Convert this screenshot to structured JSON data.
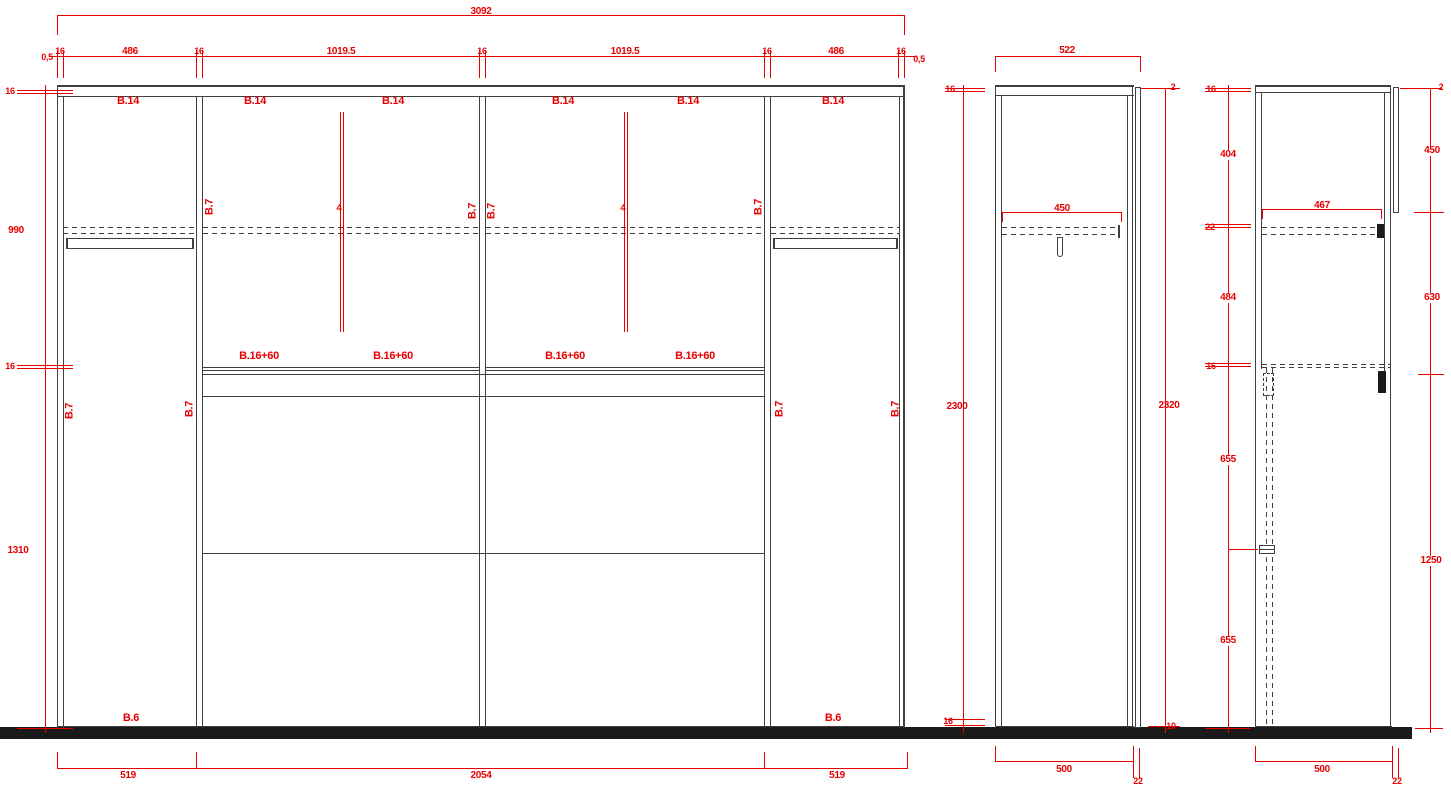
{
  "drawing": {
    "type": "cad-elevation-wardrobe",
    "colors": {
      "dimension_red": "#e80000",
      "cabinet_line": "#3f3f3f",
      "floor_black": "#1a1a1a",
      "background": "#ffffff"
    },
    "front_view": {
      "dim_overall_width": "3092",
      "dims_width_row": [
        "0,5",
        "16",
        "486",
        "16",
        "1019.5",
        "16",
        "1019.5",
        "16",
        "486",
        "16",
        "0,5"
      ],
      "dims_left_chain": [
        "16",
        "990",
        "16",
        "1310"
      ],
      "dims_bottom": [
        "519",
        "2054",
        "519"
      ],
      "top_panel_labels": [
        "B.14",
        "B.14",
        "B.14",
        "B.14",
        "B.14",
        "B.14"
      ],
      "shelf_labels": [
        "B.16+60",
        "B.16+60",
        "B.16+60",
        "B.16+60"
      ],
      "bottom_labels": [
        "B.6",
        "B.6"
      ],
      "side_panel_labels": [
        "B.7",
        "B.7",
        "B.7",
        "B.7",
        "B.7",
        "B.7",
        "B.7",
        "B.7"
      ],
      "center_line_labels": [
        "4",
        "4"
      ]
    },
    "side_view_middle": {
      "dim_top_width": "522",
      "dim_shelf_depth": "450",
      "dims_left": [
        "16",
        "2300",
        "16"
      ],
      "dims_right": [
        "2",
        "2320",
        "10"
      ],
      "dims_bottom": [
        "500",
        "22"
      ]
    },
    "side_view_right": {
      "dim_shelf_depth": "467",
      "dims_left": [
        "16",
        "404",
        "22",
        "484",
        "16",
        "655",
        "655"
      ],
      "dims_right": [
        "2",
        "450",
        "630",
        "1250"
      ],
      "dims_bottom": [
        "500",
        "22"
      ]
    }
  }
}
